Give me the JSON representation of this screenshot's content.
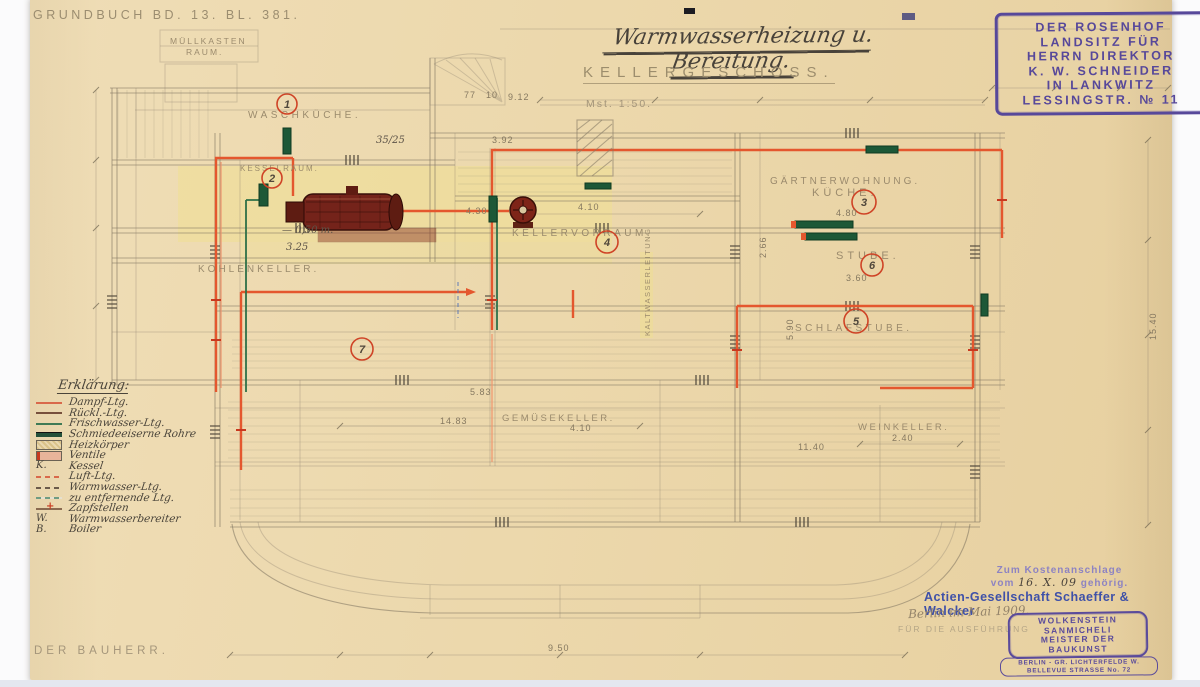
{
  "page": {
    "archive_note": "GRUNDBUCH BD. 13. BL. 381.",
    "bauherr_label": "DER BAUHERR."
  },
  "header": {
    "title": "Warmwasserheizung u. Bereitung.",
    "subtitle": "KELLERGESCHOSS.",
    "scale": "Mst. 1:50."
  },
  "owner_stamp": {
    "lines": [
      "DER ROSENHOF",
      "LANDSITZ FÜR",
      "HERRN DIREKTOR",
      "K. W. SCHNEIDER",
      "IN LANKWITZ",
      "LESSINGSTR. № 11"
    ]
  },
  "rooms": {
    "muellkasten_1": "MÜLLKASTEN",
    "muellkasten_2": "RAUM.",
    "waschkueche": "WASCHKÜCHE.",
    "kesselraum": "KESSELRAUM.",
    "kohlenkeller": "KOHLENKELLER.",
    "kellervorraum": "KELLERVORRAUM.",
    "gemuesekeller": "GEMÜSEKELLER.",
    "weinkeller": "WEINKELLER.",
    "gaertnerwohnung": "GÄRTNERWOHNUNG.",
    "kueche": "KÜCHE.",
    "stube": "STUBE.",
    "schlafstube": "SCHLAFSTUBE.",
    "kaltwasser": "KALTWASSERLEITUNG"
  },
  "room_numbers": {
    "n1": "1",
    "n2": "2",
    "n3": "3",
    "n4": "4",
    "n5": "5",
    "n6": "6",
    "n7": "7"
  },
  "dims": {
    "d1": "4.10",
    "d2": "4.30",
    "d3": "4.80",
    "d4": "3.60",
    "d5": "14.83",
    "d6": "4.10",
    "d7": "2.40",
    "d8": "11.40",
    "d9": "9.50",
    "d10": "3.92",
    "d11": "35/25",
    "d12": "— 0,50 m.",
    "d13": "3.25",
    "d14": "2.66",
    "d15": "5.90",
    "d16": "15.40",
    "d17": "77",
    "d18": "10",
    "d19": "9.12",
    "d20": "5.83"
  },
  "legend": {
    "heading": "Erklärung:",
    "items": [
      {
        "sym": "",
        "label": "Dampf-Ltg."
      },
      {
        "sym": "",
        "label": "Rückl.-Ltg."
      },
      {
        "sym": "",
        "label": "Frischwasser-Ltg."
      },
      {
        "sym": "",
        "label": "Schmiedeeiserne Rohre"
      },
      {
        "sym": "",
        "label": "Heizkörper"
      },
      {
        "sym": "",
        "label": "Ventile"
      },
      {
        "sym": "K.",
        "label": "Kessel"
      },
      {
        "sym": "",
        "label": "Luft-Ltg."
      },
      {
        "sym": "",
        "label": "Warmwasser-Ltg."
      },
      {
        "sym": "",
        "label": "zu entfernende Ltg."
      },
      {
        "sym": "",
        "label": "Zapfstellen"
      },
      {
        "sym": "W.",
        "label": "Warmwasserbereiter"
      },
      {
        "sym": "B.",
        "label": "Boiler"
      }
    ]
  },
  "footer": {
    "cost_line1": "Zum Kostenanschlage",
    "cost_vom": "vom",
    "cost_date": "16. X. 09",
    "cost_suffix": "gehörig.",
    "company": "Actien-Gesellschaft Schaeffer & Walcker",
    "handwritten_date": "Berlin im Mai 1909.",
    "ausfuehrung": "FÜR DIE AUSFÜHRUNG",
    "architect_stamp": [
      "WOLKENSTEIN",
      "SANMICHELI",
      "MEISTER DER",
      "BAUKUNST"
    ],
    "address_stamp": [
      "BERLIN - GR. LICHTERFELDE W.",
      "BELLEVUE STRASSE No. 72"
    ]
  }
}
